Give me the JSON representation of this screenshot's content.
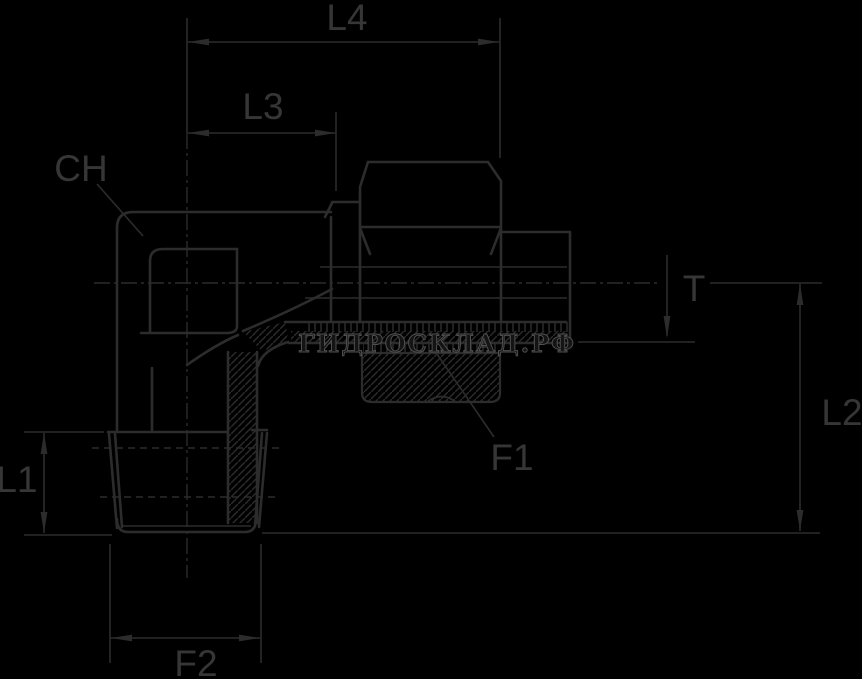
{
  "drawing": {
    "type": "technical-drawing",
    "subject": "90-degree elbow hydraulic fitting, sectioned side view with dimension callouts"
  },
  "labels": {
    "l4": "L4",
    "l3": "L3",
    "ch": "CH",
    "t": "T",
    "l2": "L2",
    "l1": "L1",
    "f1": "F1",
    "f2": "F2"
  },
  "watermark": {
    "text": "ГИДРОСКЛАД.РФ"
  },
  "colors": {
    "background": "#000000",
    "line": "#2c2c2c",
    "label": "#363636",
    "watermark_fill": "#141414",
    "watermark_stroke": "#4f4f4f"
  }
}
